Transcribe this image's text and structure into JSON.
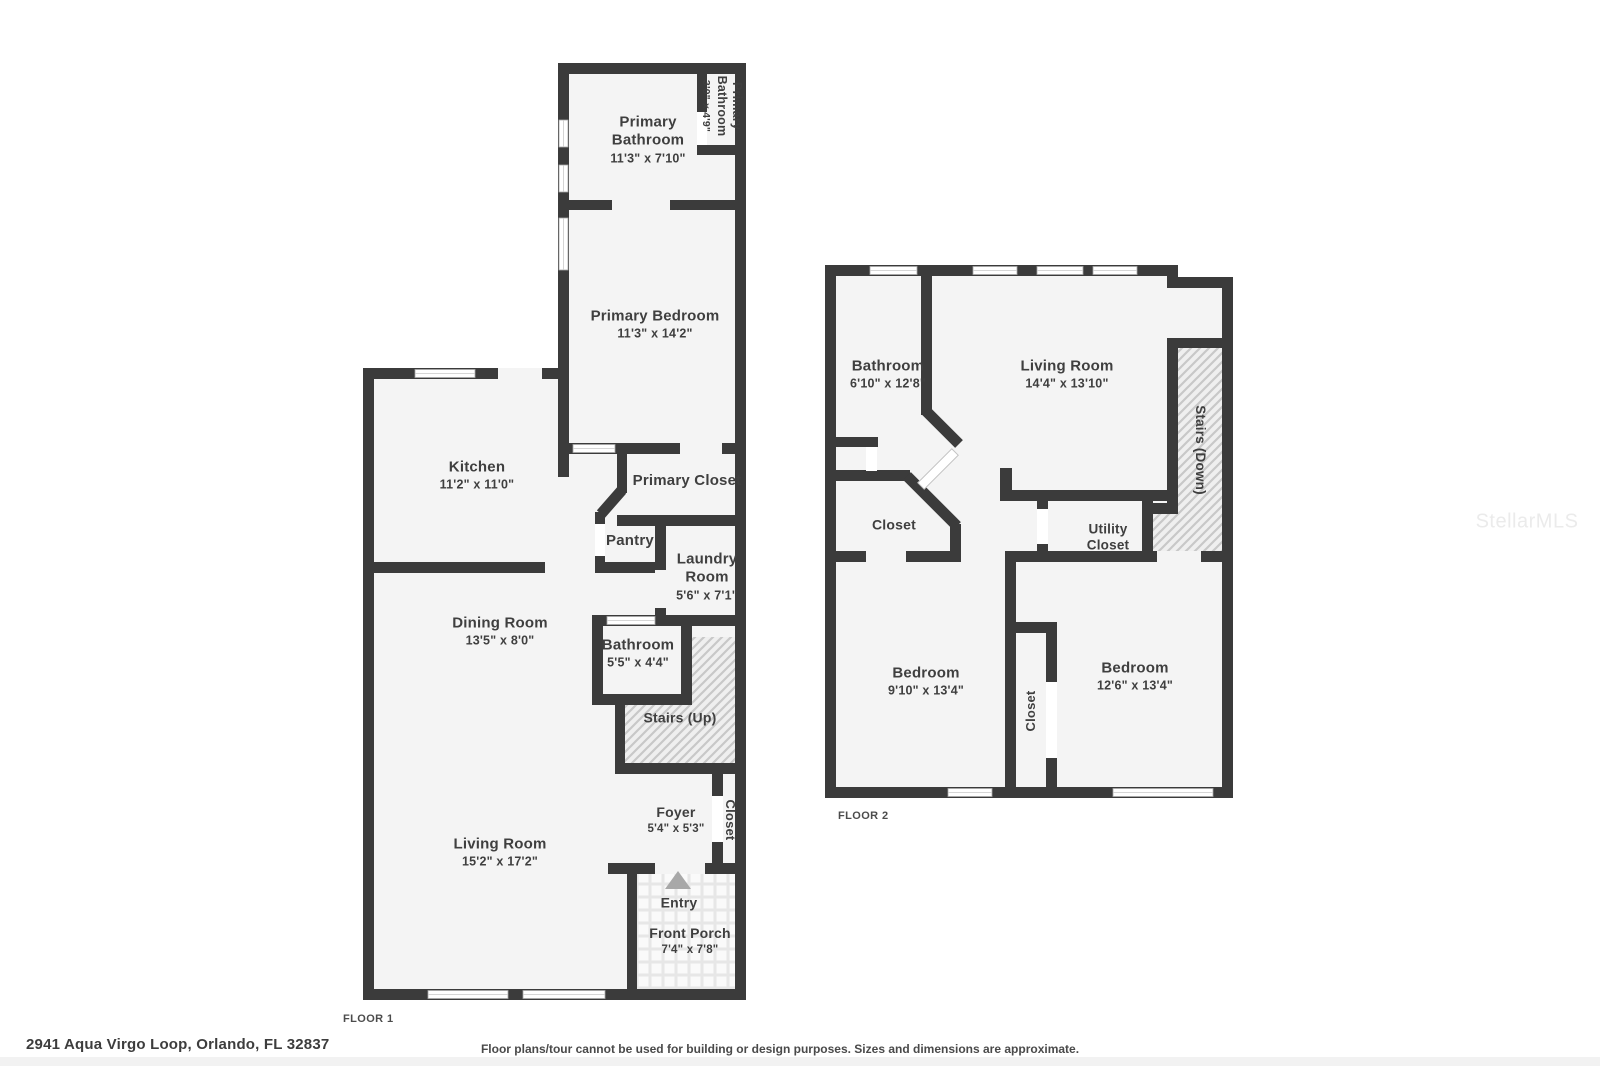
{
  "address": "2941 Aqua Virgo Loop, Orlando, FL 32837",
  "disclaimer": "Floor plans/tour cannot be used for building or design purposes. Sizes and dimensions are approximate.",
  "watermark": "StellarMLS",
  "colors": {
    "wall": "#3b3b3b",
    "room_fill": "#f4f4f4",
    "hatch_line": "#c8c8c8",
    "entry_arrow": "#a8a8a8"
  },
  "floor1": {
    "label": "FLOOR 1",
    "rooms": {
      "primary_bathroom": {
        "name": "Primary Bathroom",
        "dims": "11'3\" x 7'10\""
      },
      "primary_bathroom_small": {
        "name": "Primary Bathroom",
        "dims": "3'0\" x 4'9\""
      },
      "primary_bedroom": {
        "name": "Primary Bedroom",
        "dims": "11'3\" x 14'2\""
      },
      "kitchen": {
        "name": "Kitchen",
        "dims": "11'2\" x 11'0\""
      },
      "primary_closet": {
        "name": "Primary Closet"
      },
      "pantry": {
        "name": "Pantry"
      },
      "laundry": {
        "name": "Laundry Room",
        "dims": "5'6\" x 7'1\""
      },
      "dining": {
        "name": "Dining Room",
        "dims": "13'5\" x 8'0\""
      },
      "bathroom": {
        "name": "Bathroom",
        "dims": "5'5\" x 4'4\""
      },
      "stairs": {
        "name": "Stairs (Up)"
      },
      "foyer": {
        "name": "Foyer",
        "dims": "5'4\" x 5'3\""
      },
      "closet": {
        "name": "Closet"
      },
      "living": {
        "name": "Living Room",
        "dims": "15'2\" x 17'2\""
      },
      "entry": {
        "name": "Entry"
      },
      "porch": {
        "name": "Front Porch",
        "dims": "7'4\" x 7'8\""
      }
    }
  },
  "floor2": {
    "label": "FLOOR 2",
    "rooms": {
      "bathroom": {
        "name": "Bathroom",
        "dims": "6'10\" x 12'8\""
      },
      "living": {
        "name": "Living Room",
        "dims": "14'4\" x 13'10\""
      },
      "stairs": {
        "name": "Stairs (Down)"
      },
      "closet": {
        "name": "Closet"
      },
      "utility": {
        "name": "Utility Closet"
      },
      "bedroom_left": {
        "name": "Bedroom",
        "dims": "9'10\" x 13'4\""
      },
      "bedroom_closet": {
        "name": "Closet"
      },
      "bedroom_right": {
        "name": "Bedroom",
        "dims": "12'6\" x 13'4\""
      }
    }
  }
}
